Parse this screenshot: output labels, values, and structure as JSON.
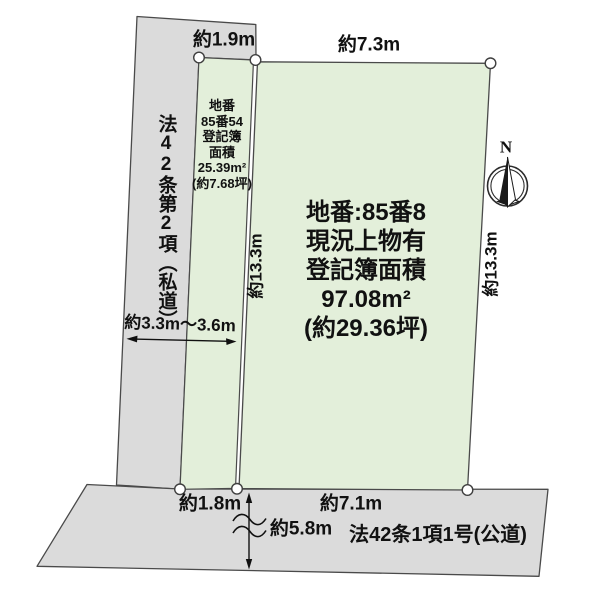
{
  "parcels": {
    "small": {
      "label_lines": [
        "地番",
        "85番54",
        "登記簿",
        "面積",
        "25.39m²",
        "(約7.68坪)"
      ]
    },
    "large": {
      "label_lines": [
        "地番:85番8",
        "現況上物有",
        "登記簿面積",
        "97.08m²",
        "(約29.36坪)"
      ]
    }
  },
  "roads": {
    "left": {
      "label": "法42条第2項（私道）"
    },
    "bottom": {
      "label": "法42条1項1号(公道)"
    }
  },
  "dimensions": {
    "top_small_width": "約1.9m",
    "top_large_width": "約7.3m",
    "left_depth": "約13.3m",
    "right_depth": "約13.3m",
    "left_road_width": "約3.3m〜3.6m",
    "bottom_small_width": "約1.8m",
    "bottom_large_width": "約7.1m",
    "bottom_road_span": "約5.8m"
  },
  "compass": {
    "label": "N"
  },
  "colors": {
    "parcel_green": "#e3efda",
    "road_gray": "#dbdbdb",
    "outline": "#4a4a4a",
    "ink": "#111111"
  }
}
